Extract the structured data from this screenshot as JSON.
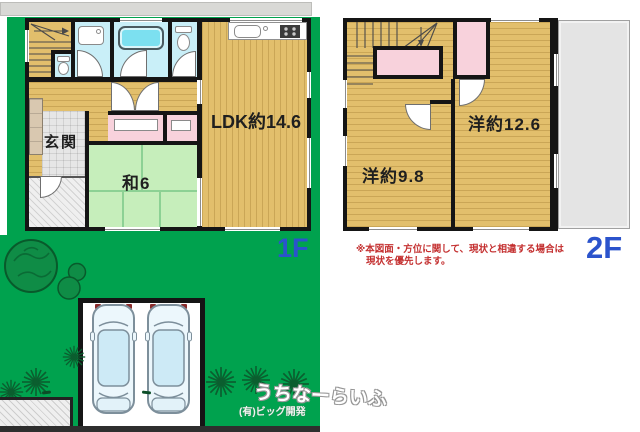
{
  "floor1": {
    "floor_label": "1F",
    "rooms": {
      "genkan": "玄関",
      "washitsu": "和6",
      "ldk": "LDK約14.6"
    }
  },
  "floor2": {
    "floor_label": "2F",
    "rooms": {
      "west_room": "洋約9.8",
      "east_room": "洋約12.6"
    }
  },
  "notes": {
    "disclaimer_line1": "※本図面・方位に関して、現状と相違する場合は",
    "disclaimer_line2": "現状を優先します。"
  },
  "branding": {
    "watermark": "うちなーらいふ",
    "company": "(有)ビッグ開発"
  },
  "colors": {
    "yard_green": "#00a24e",
    "floor_tan": "#e2bf6c",
    "tatami_green": "#c6eebb",
    "wet_area_blue": "#c9eff8",
    "closet_pink": "#f8d2dc",
    "floor_label_blue": "#2b53cc",
    "disclaimer_red": "#c43030",
    "wall_black": "#151515",
    "balcony_gray": "#e4e4e4"
  }
}
